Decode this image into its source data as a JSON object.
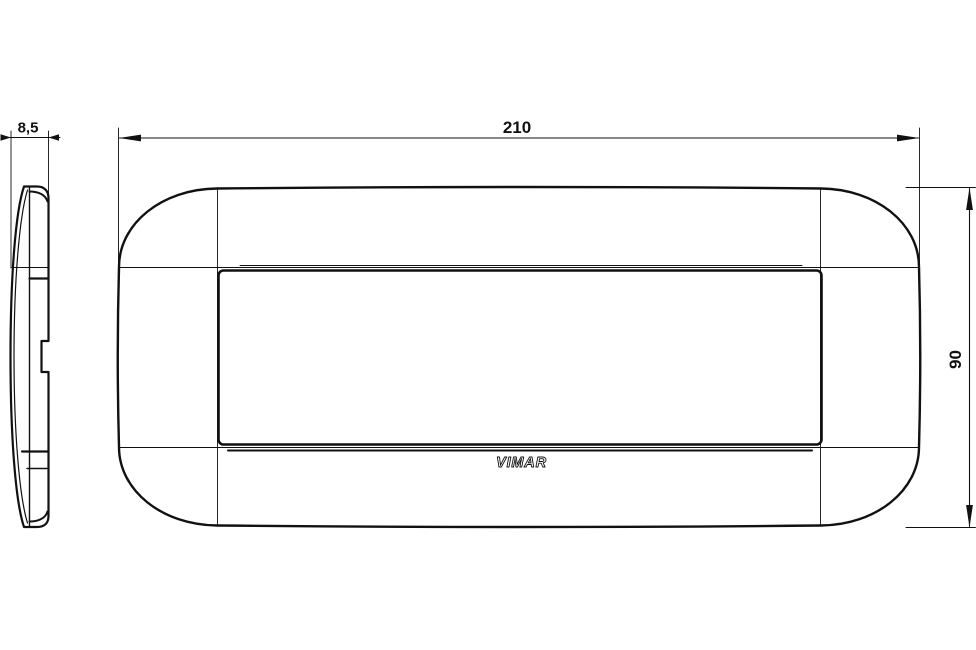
{
  "drawing": {
    "colors": {
      "line": "#111111",
      "background": "#ffffff"
    },
    "dimensions": {
      "plate_width": "210",
      "plate_height": "90",
      "plate_thickness": "8,5"
    },
    "brand": "VIMAR"
  }
}
